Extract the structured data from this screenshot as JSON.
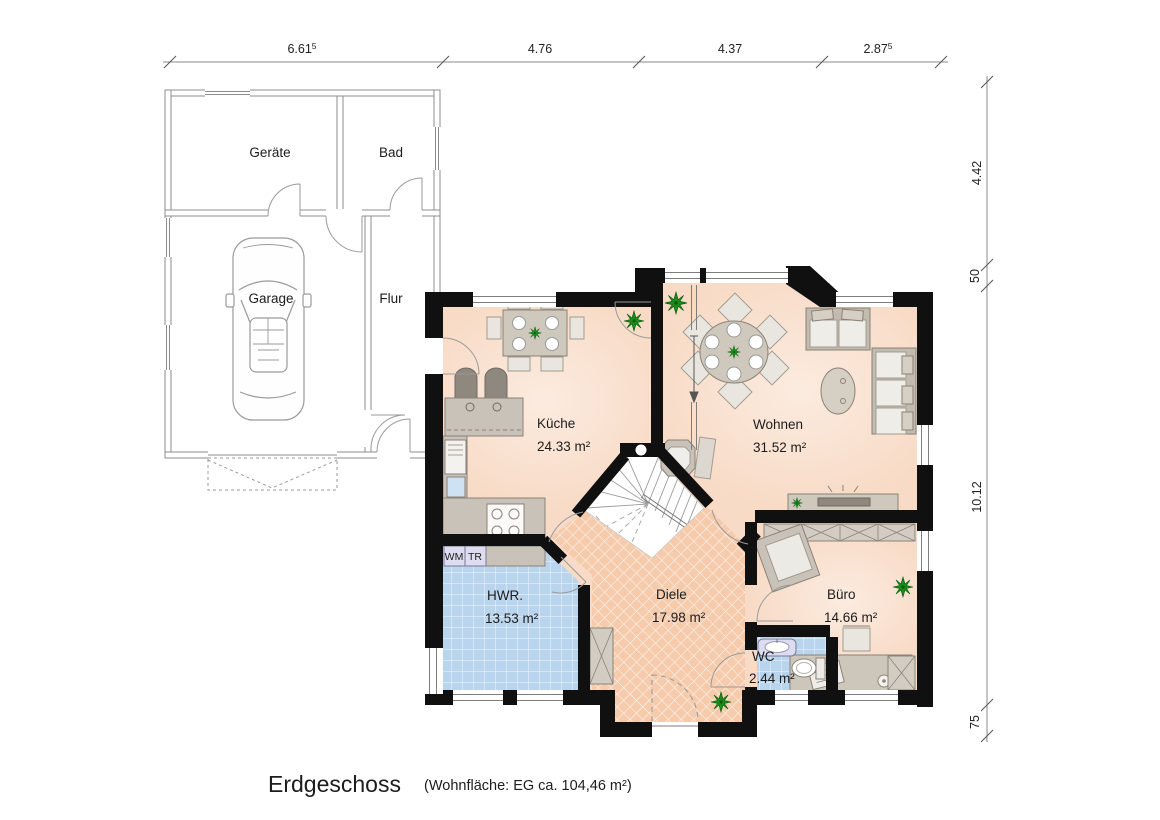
{
  "title": {
    "main": "Erdgeschoss",
    "sub": "(Wohnfläche: EG  ca. 104,46 m²)"
  },
  "dims": {
    "top": [
      {
        "v": "6.61",
        "sup": "5"
      },
      {
        "v": "4.76",
        "sup": ""
      },
      {
        "v": "4.37",
        "sup": ""
      },
      {
        "v": "2.87",
        "sup": "5"
      }
    ],
    "right": [
      {
        "v": "4.42"
      },
      {
        "v": "50"
      },
      {
        "v": "10.12"
      },
      {
        "v": "75"
      }
    ]
  },
  "annex": {
    "geraete": "Geräte",
    "bad": "Bad",
    "garage": "Garage",
    "flur": "Flur"
  },
  "rooms": {
    "kueche": {
      "name": "Küche",
      "area": "24.33 m²"
    },
    "wohnen": {
      "name": "Wohnen",
      "area": "31.52 m²"
    },
    "hwr": {
      "name": "HWR.",
      "area": "13.53 m²"
    },
    "diele": {
      "name": "Diele",
      "area": "17.98 m²"
    },
    "buero": {
      "name": "Büro",
      "area": "14.66 m²"
    },
    "wc": {
      "name": "WC",
      "area": "2.44 m²"
    }
  },
  "appliances": {
    "wm": "WM",
    "tr": "TR"
  },
  "colors": {
    "wall": "#101010",
    "floor": "#f8dbc6",
    "diele_hatch": "#f5cbac",
    "tile_blue": "#b9d4ed",
    "counter_gray": "#c9c2b8",
    "appliance_lavender": "#dedcf0",
    "plant_green": "#1d8a1d",
    "annex_line": "#8c8c8c"
  }
}
